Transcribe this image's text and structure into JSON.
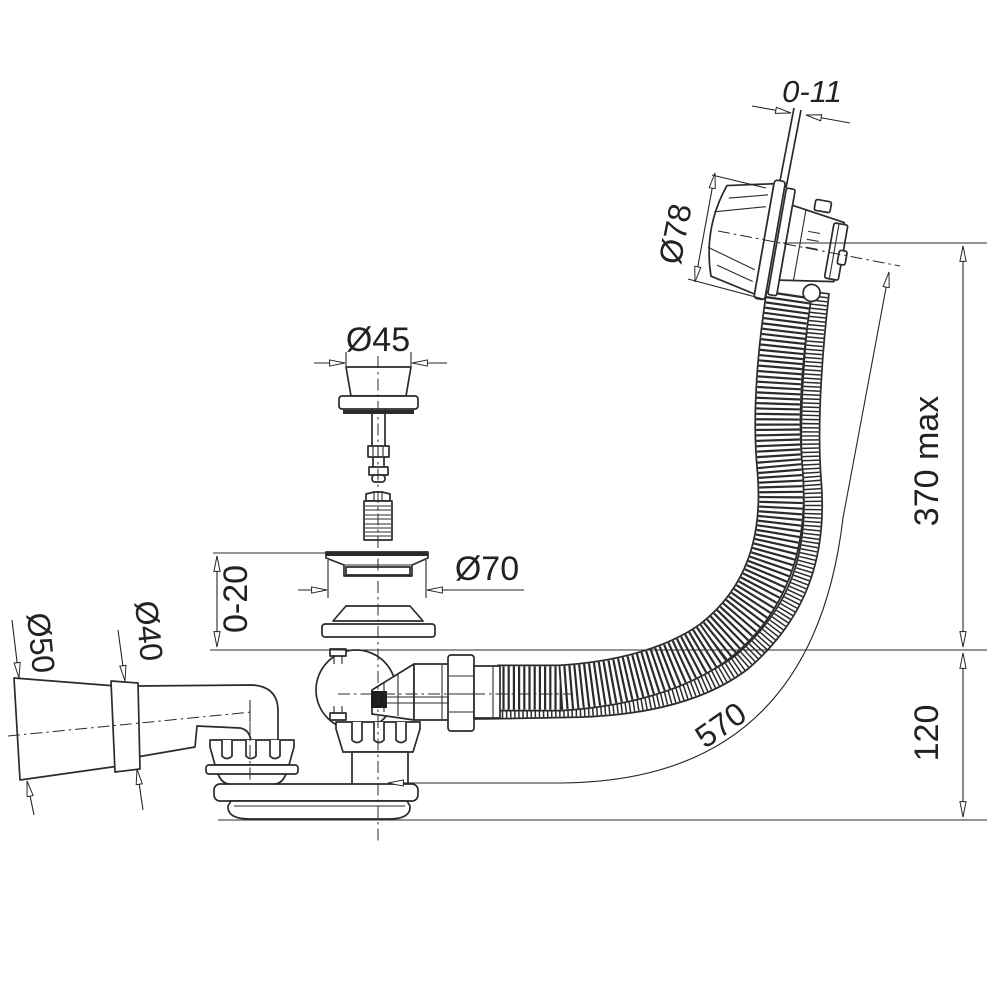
{
  "drawing": {
    "kind": "technical-drawing",
    "subject": "bath waste, overflow and trap kit - side elevation with dimensions",
    "colors": {
      "line": "#2b2b2b",
      "background": "#ffffff"
    },
    "labels": {
      "cable_travel": "0-11",
      "overflow_head_dia": "Ø78",
      "plug_dia": "Ø45",
      "flange_dia": "Ø70",
      "flange_height": "0-20",
      "outlet_dia_outer": "Ø50",
      "outlet_dia_inner": "Ø40",
      "max_height": "370 max",
      "trap_depth": "120",
      "hose_length": "570"
    }
  }
}
